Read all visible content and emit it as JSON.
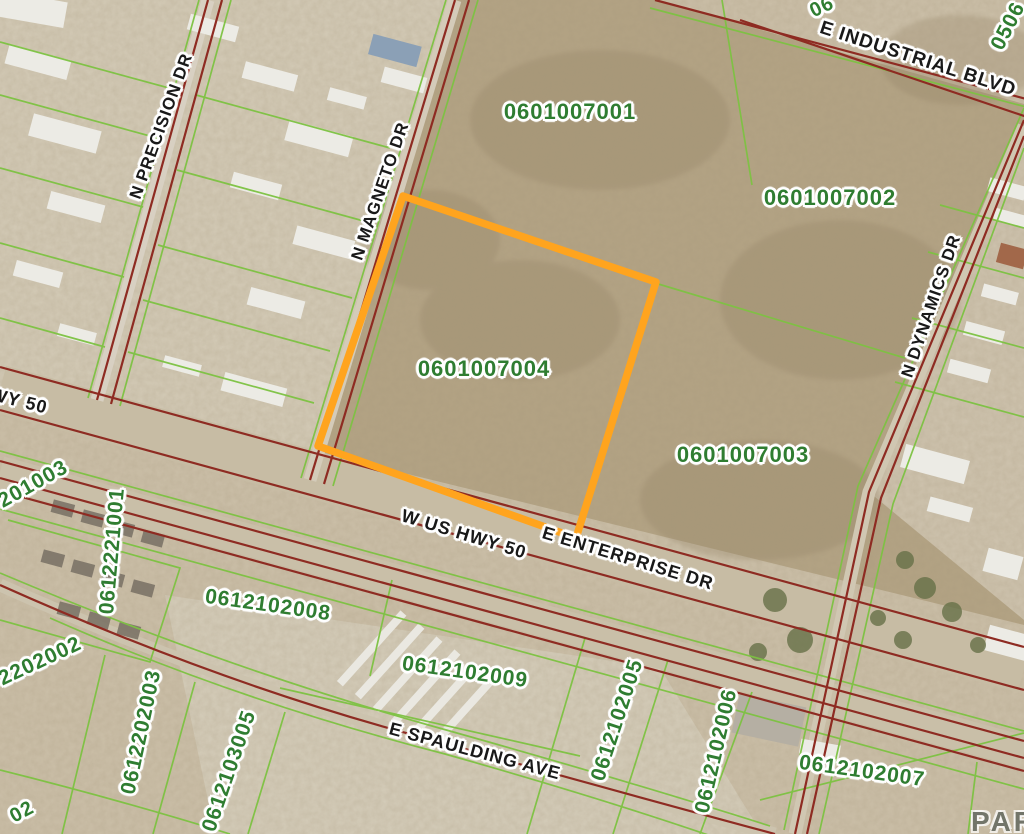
{
  "map": {
    "description": "Aerial parcel map with highlighted lot",
    "labels": {
      "streets": [
        {
          "text": "E INDUSTRIAL BLVD"
        },
        {
          "text": "HWY 50"
        },
        {
          "text": "N PRECISION DR"
        },
        {
          "text": "N MAGNETO DR"
        },
        {
          "text": "N DYNAMICS DR"
        },
        {
          "text": "W US HWY 50"
        },
        {
          "text": "E ENTERPRISE DR"
        },
        {
          "text": "E SPAULDING AVE"
        }
      ],
      "parcels": [
        {
          "text": "0601007001"
        },
        {
          "text": "0601007002"
        },
        {
          "text": "0601007004"
        },
        {
          "text": "0601007003"
        },
        {
          "text": "0506"
        },
        {
          "text": "06"
        },
        {
          "text": "201003"
        },
        {
          "text": "0612221001"
        },
        {
          "text": "2202002"
        },
        {
          "text": "0612202003"
        },
        {
          "text": "0612103005"
        },
        {
          "text": "0612102008"
        },
        {
          "text": "0612102009"
        },
        {
          "text": "0612102005"
        },
        {
          "text": "0612102006"
        },
        {
          "text": "0612102007"
        },
        {
          "text": "02"
        }
      ],
      "watermark": "PAR"
    },
    "highlighted_parcel": {
      "number": "0601007004",
      "outline_color": "#FFA41E"
    },
    "colors": {
      "terrain": "#cbbfa8",
      "scrub": "#b3a384",
      "road_line": "#8e2b22",
      "parcel_line": "#7dc242",
      "parcel_text": "#2f7d31",
      "street_text": "#191919",
      "highlight": "#FFA41E",
      "watermark": "#6a6e64"
    }
  }
}
